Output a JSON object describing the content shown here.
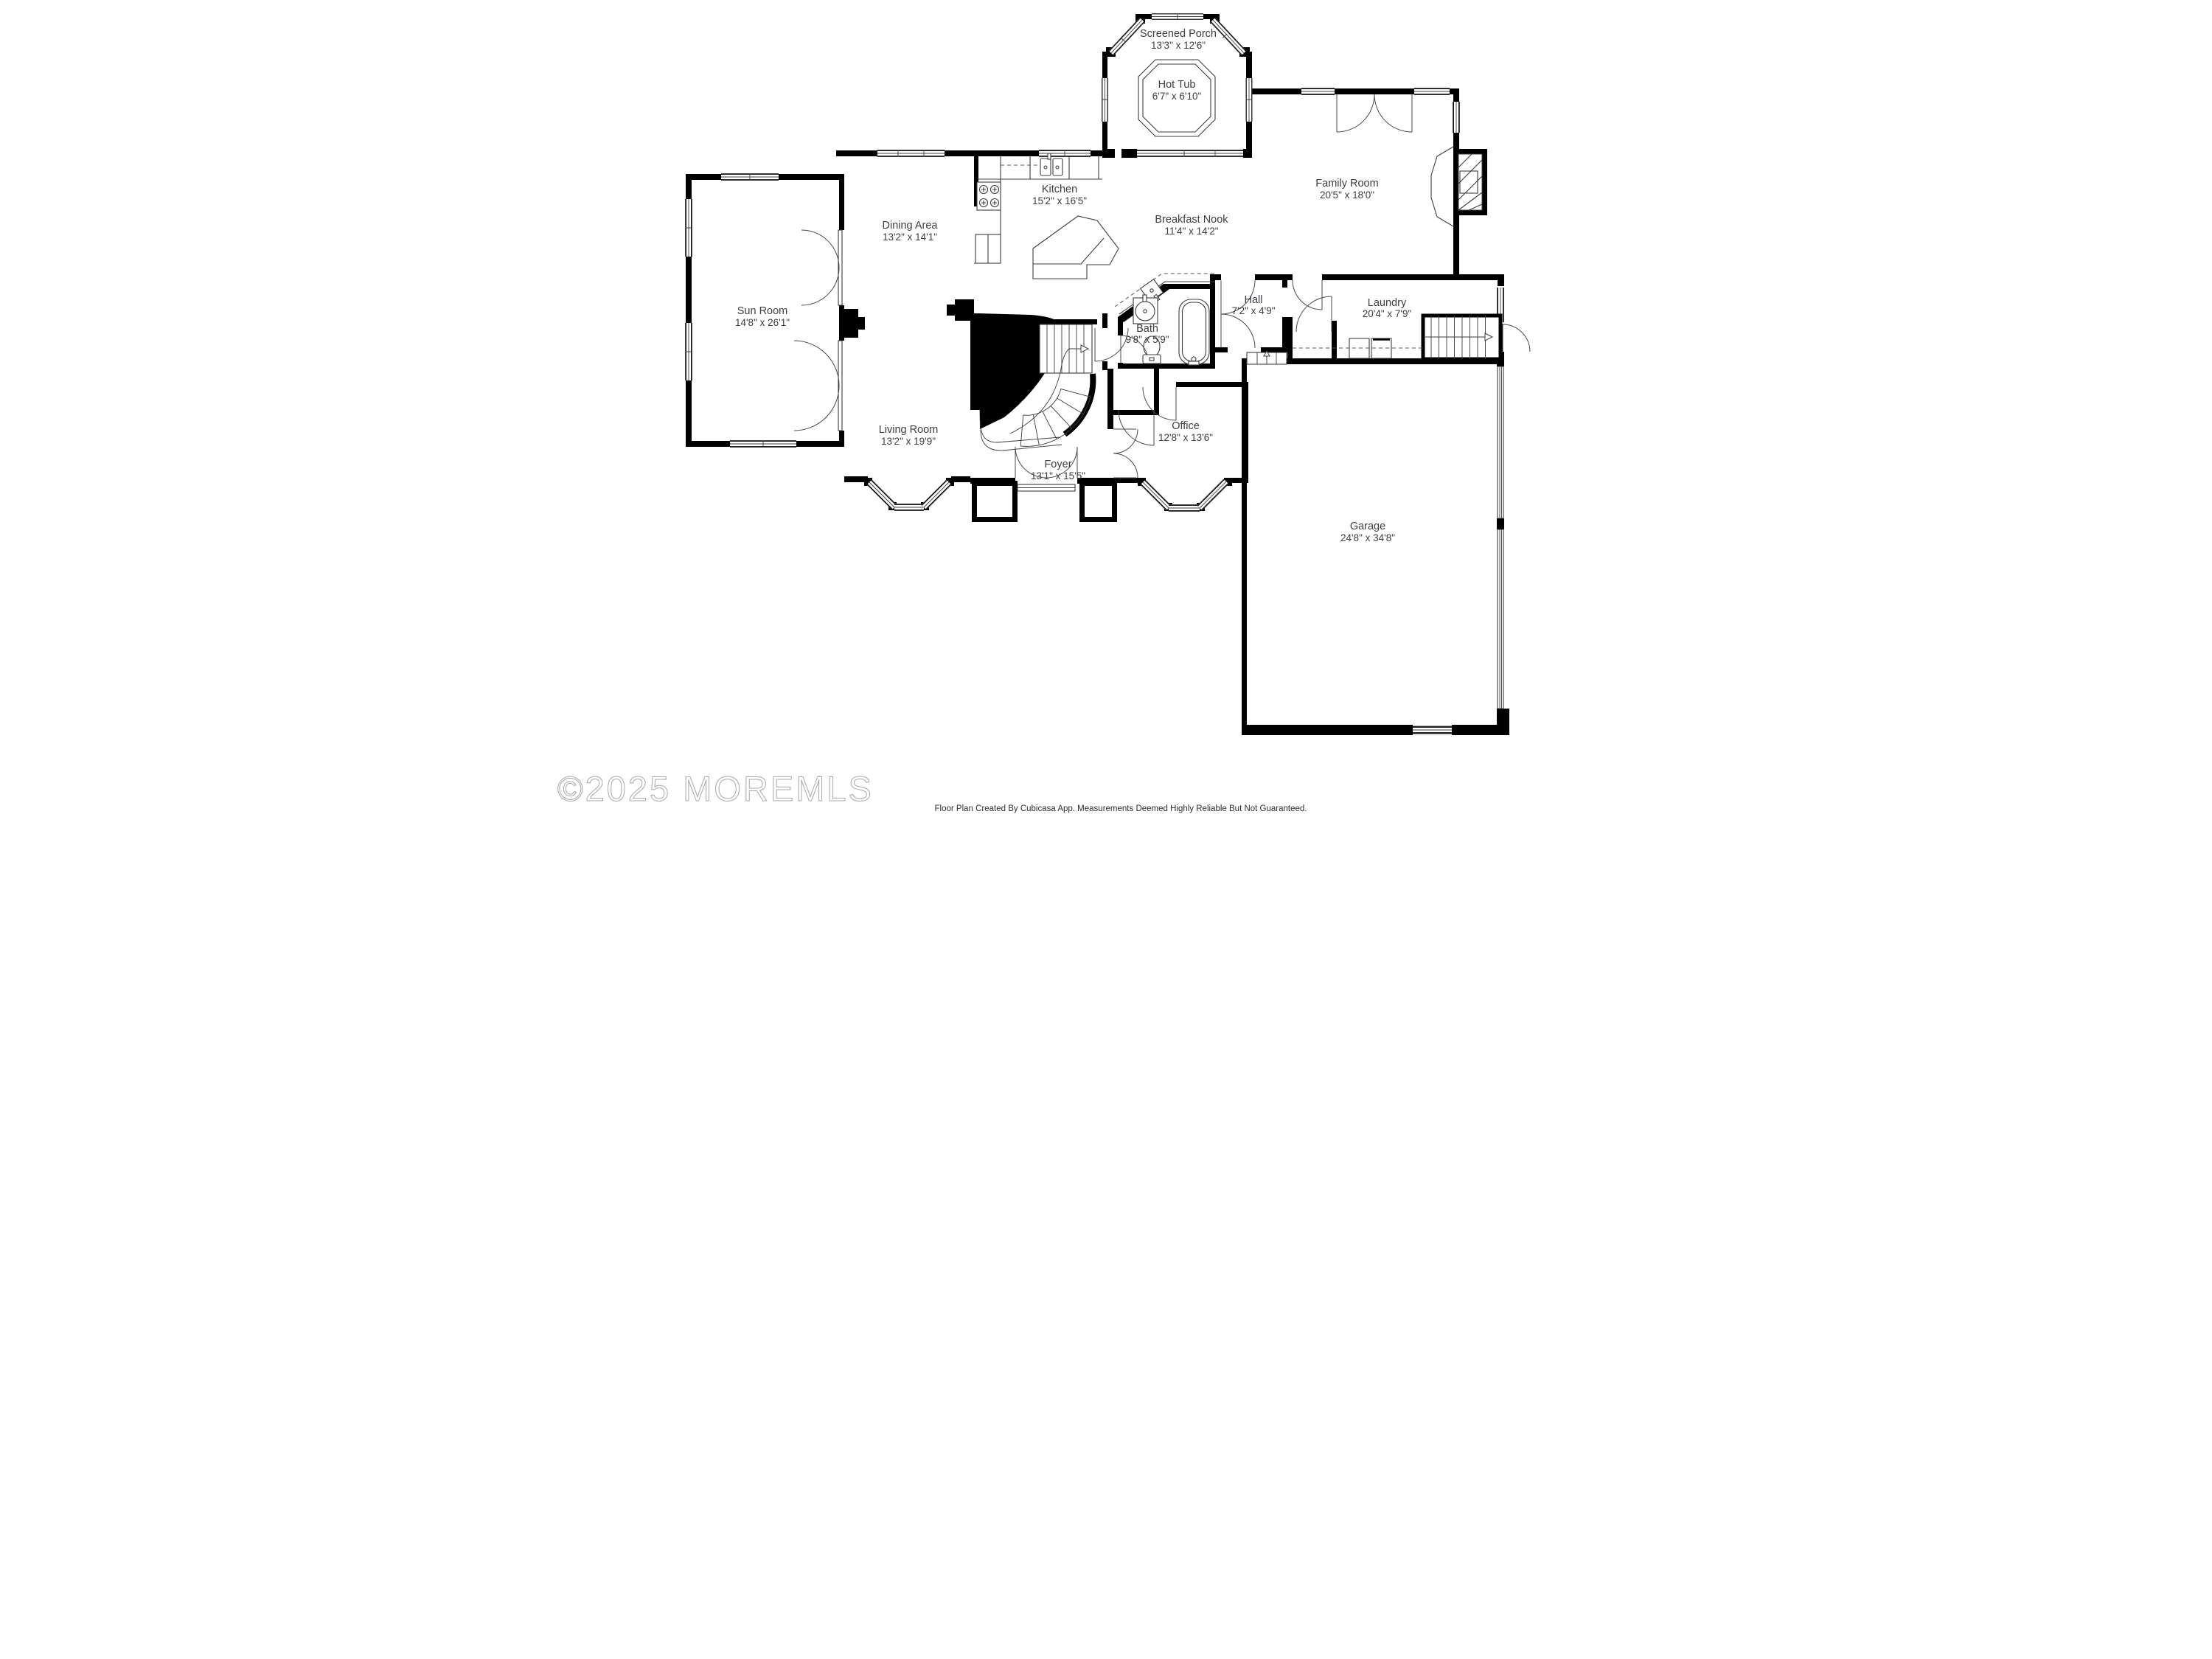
{
  "plan_title": "First Floor Plan",
  "watermark": {
    "text": "©2025 MOREMLS"
  },
  "footer": {
    "text": "Floor Plan Created By Cubicasa App. Measurements Deemed Highly Reliable But Not Guaranteed."
  },
  "colors": {
    "wall": "#000000",
    "line": "#3c3c3c",
    "label": "#3d3d42",
    "watermark_stroke": "#9a9a9a",
    "background": "#ffffff"
  },
  "rooms": [
    {
      "id": "screened-porch",
      "name": "Screened Porch",
      "dims": "13'3\" x 12'6\""
    },
    {
      "id": "hot-tub",
      "name": "Hot Tub",
      "dims": "6'7\" x 6'10\""
    },
    {
      "id": "family-room",
      "name": "Family Room",
      "dims": "20'5\" x 18'0\""
    },
    {
      "id": "kitchen",
      "name": "Kitchen",
      "dims": "15'2\" x 16'5\""
    },
    {
      "id": "breakfast-nook",
      "name": "Breakfast Nook",
      "dims": "11'4\" x 14'2\""
    },
    {
      "id": "dining-area",
      "name": "Dining Area",
      "dims": "13'2\" x 14'1\""
    },
    {
      "id": "sun-room",
      "name": "Sun Room",
      "dims": "14'8\" x 26'1\""
    },
    {
      "id": "living-room",
      "name": "Living Room",
      "dims": "13'2\" x 19'9\""
    },
    {
      "id": "foyer",
      "name": "Foyer",
      "dims": "13'1\" x 15'5\""
    },
    {
      "id": "bath",
      "name": "Bath",
      "dims": "9'8\" x 5'9\""
    },
    {
      "id": "hall",
      "name": "Hall",
      "dims": "7'2\" x 4'9\""
    },
    {
      "id": "laundry",
      "name": "Laundry",
      "dims": "20'4\" x 7'9\""
    },
    {
      "id": "office",
      "name": "Office",
      "dims": "12'8\" x 13'6\""
    },
    {
      "id": "garage",
      "name": "Garage",
      "dims": "24'8\" x 34'8\""
    }
  ]
}
